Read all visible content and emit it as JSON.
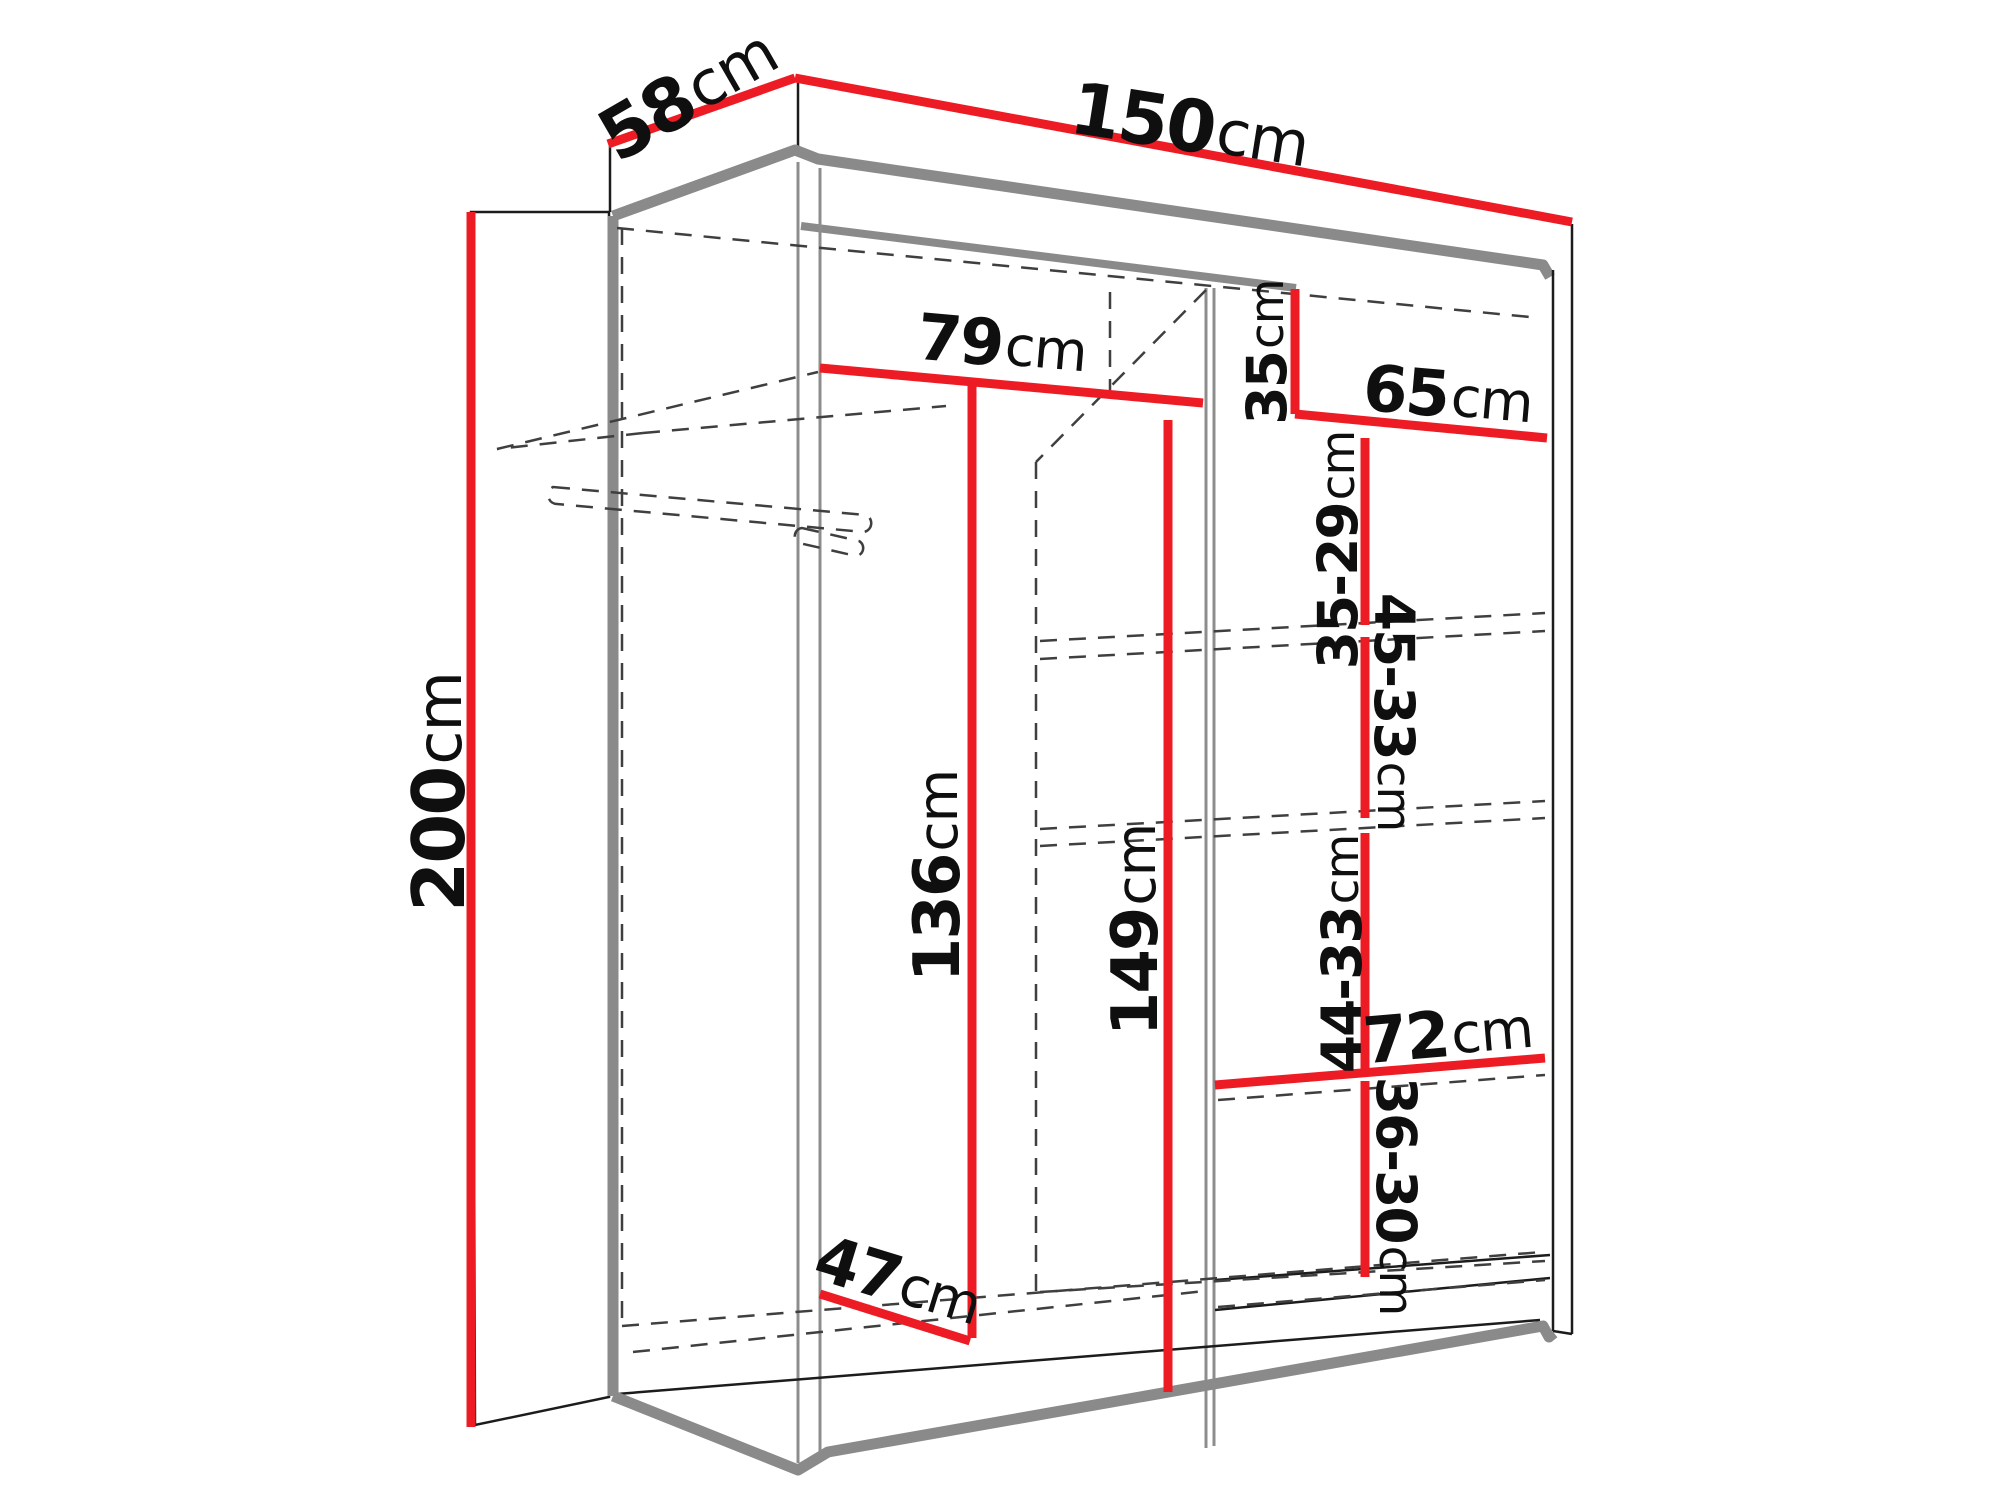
{
  "diagram": {
    "type": "furniture-dimension-drawing",
    "subject": "two-door sliding wardrobe with shelves and hanging rail",
    "unit_default": "cm",
    "colors": {
      "dimension_line": "#ed1c24",
      "outline": "#1c1c1c",
      "accent_edge": "#8a8a8a",
      "hidden_line": "#3f3f3f",
      "background": "#ffffff"
    },
    "dimensions": {
      "width": {
        "value": "150",
        "unit": "cm"
      },
      "depth": {
        "value": "58",
        "unit": "cm"
      },
      "height": {
        "value": "200",
        "unit": "cm"
      },
      "left_compartment_width": {
        "value": "79",
        "unit": "cm"
      },
      "top_compartment_height": {
        "value": "35",
        "unit": "cm"
      },
      "right_compartment_width": {
        "value": "65",
        "unit": "cm"
      },
      "shelf_spacing_1": {
        "value": "35-29",
        "unit": "cm"
      },
      "shelf_spacing_2": {
        "value": "45-33",
        "unit": "cm"
      },
      "hanging_space_height": {
        "value": "136",
        "unit": "cm"
      },
      "middle_section_height": {
        "value": "149",
        "unit": "cm"
      },
      "shelf_spacing_3": {
        "value": "44-33",
        "unit": "cm"
      },
      "bottom_shelf_width": {
        "value": "72",
        "unit": "cm"
      },
      "shelf_spacing_4": {
        "value": "36-30",
        "unit": "cm"
      },
      "interior_depth": {
        "value": "47",
        "unit": "cm"
      }
    }
  }
}
